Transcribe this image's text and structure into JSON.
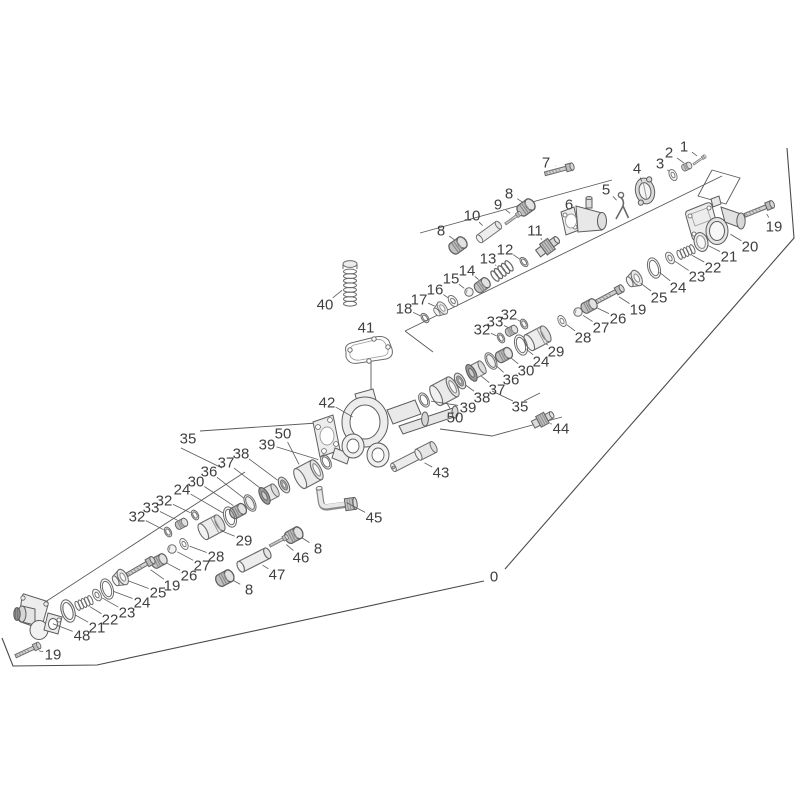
{
  "meta": {
    "background": "#ffffff",
    "label_color": "#3f3f3f",
    "label_font_size": 15,
    "leader_color": "#5a5a5a",
    "construction_color": "#5a5a5a",
    "boundary_color": "#4a4a4a",
    "part_stroke": "#6a6a6a"
  },
  "boundary": {
    "label": "0",
    "label_pos": [
      494,
      576
    ],
    "segments": [
      [
        [
          787,
          148
        ],
        [
          794,
          238
        ],
        [
          505,
          569
        ]
      ],
      [
        [
          484,
          581
        ],
        [
          97,
          665
        ],
        [
          13,
          666
        ],
        [
          2,
          638
        ]
      ]
    ]
  },
  "construction_lines": [
    [
      [
        612,
        180
      ],
      [
        420,
        233
      ]
    ],
    [
      [
        722,
        176
      ],
      [
        405,
        331
      ]
    ],
    [
      [
        405,
        331
      ],
      [
        433,
        352
      ]
    ],
    [
      [
        712,
        170
      ],
      [
        740,
        178
      ],
      [
        726,
        204
      ],
      [
        698,
        196
      ],
      [
        712,
        170
      ]
    ],
    [
      [
        245,
        472
      ],
      [
        36,
        608
      ]
    ],
    [
      [
        200,
        431
      ],
      [
        317,
        423
      ]
    ],
    [
      [
        181,
        448
      ],
      [
        222,
        468
      ]
    ],
    [
      [
        513,
        401
      ],
      [
        492,
        391
      ]
    ],
    [
      [
        524,
        401
      ],
      [
        540,
        393
      ]
    ],
    [
      [
        371,
        362
      ],
      [
        371,
        392
      ]
    ],
    [
      [
        440,
        429
      ],
      [
        492,
        436
      ],
      [
        562,
        417
      ]
    ]
  ],
  "parts": [
    {
      "label": "42",
      "type": "pumpbody",
      "x": 375,
      "y": 430,
      "lx": 327,
      "ly": 402,
      "rot": 0,
      "s": 1,
      "gap": 26
    },
    {
      "label": "20",
      "type": "manifold20",
      "x": 715,
      "y": 225,
      "lx": 750,
      "ly": 246,
      "rot": 0,
      "s": 1,
      "gap": 18
    },
    {
      "label": "48",
      "type": "manifold48",
      "x": 38,
      "y": 618,
      "lx": 82,
      "ly": 635,
      "rot": 0,
      "s": 1,
      "gap": 16
    },
    {
      "label": "6",
      "type": "valvebody",
      "x": 584,
      "y": 220,
      "lx": 569,
      "ly": 204,
      "rot": 0,
      "s": 1,
      "gap": 12
    },
    {
      "label": "7",
      "type": "bolt",
      "x": 563,
      "y": 169,
      "lx": 546,
      "ly": 162,
      "rot": -15,
      "s": 1.1,
      "gap": 8
    },
    {
      "label": "1",
      "type": "bolt",
      "x": 701,
      "y": 159,
      "lx": 684,
      "ly": 146,
      "rot": -35,
      "s": 0.55,
      "gap": 5
    },
    {
      "label": "2",
      "type": "nut",
      "x": 688,
      "y": 166,
      "lx": 669,
      "ly": 152,
      "rot": -25,
      "s": 0.7,
      "gap": 5
    },
    {
      "label": "3",
      "type": "washer",
      "x": 673,
      "y": 175,
      "lx": 660,
      "ly": 163,
      "rot": -25,
      "s": 0.85,
      "gap": 5
    },
    {
      "label": "4",
      "type": "flangedisc",
      "x": 645,
      "y": 191,
      "lx": 637,
      "ly": 168,
      "rot": -12,
      "s": 1,
      "gap": 10
    },
    {
      "label": "5",
      "type": "clip",
      "x": 622,
      "y": 206,
      "lx": 606,
      "ly": 189,
      "rot": 0,
      "s": 1,
      "gap": 8
    },
    {
      "label": "19",
      "type": "bolt",
      "x": 763,
      "y": 208,
      "lx": 774,
      "ly": 226,
      "rot": -22,
      "s": 1.15,
      "gap": 7
    },
    {
      "label": "21",
      "type": "plug",
      "x": 701,
      "y": 242,
      "lx": 729,
      "ly": 256,
      "rot": -15,
      "s": 1,
      "gap": 8
    },
    {
      "label": "22",
      "type": "spring",
      "x": 686,
      "y": 252,
      "lx": 713,
      "ly": 267,
      "rot": -24,
      "s": 1,
      "gap": 7
    },
    {
      "label": "23",
      "type": "washer",
      "x": 670,
      "y": 258,
      "lx": 697,
      "ly": 276,
      "rot": -28,
      "s": 0.9,
      "gap": 6
    },
    {
      "label": "24",
      "type": "bigring",
      "x": 654,
      "y": 268,
      "lx": 678,
      "ly": 287,
      "rot": -18,
      "s": 1,
      "gap": 7
    },
    {
      "label": "25",
      "type": "cup",
      "x": 635,
      "y": 279,
      "lx": 659,
      "ly": 297,
      "rot": -28,
      "s": 1,
      "gap": 7
    },
    {
      "label": "19",
      "type": "bolt",
      "x": 613,
      "y": 293,
      "lx": 638,
      "ly": 309,
      "rot": -28,
      "s": 1.15,
      "gap": 7
    },
    {
      "label": "26",
      "type": "nut",
      "x": 591,
      "y": 305,
      "lx": 618,
      "ly": 318,
      "rot": -28,
      "s": 1.1,
      "gap": 7
    },
    {
      "label": "27",
      "type": "ball",
      "x": 578,
      "y": 312,
      "lx": 601,
      "ly": 327,
      "rot": 0,
      "s": 1,
      "gap": 6
    },
    {
      "label": "28",
      "type": "washer",
      "x": 562,
      "y": 321,
      "lx": 583,
      "ly": 337,
      "rot": -28,
      "s": 0.85,
      "gap": 6
    },
    {
      "label": "32",
      "type": "orings",
      "x": 524,
      "y": 324,
      "lx": 509,
      "ly": 314,
      "rot": -28,
      "s": 1,
      "gap": 5
    },
    {
      "label": "33",
      "type": "nut",
      "x": 513,
      "y": 330,
      "lx": 495,
      "ly": 321,
      "rot": -28,
      "s": 0.85,
      "gap": 5
    },
    {
      "label": "32",
      "type": "orings",
      "x": 501,
      "y": 338,
      "lx": 482,
      "ly": 329,
      "rot": -28,
      "s": 1,
      "gap": 5
    },
    {
      "label": "29",
      "type": "piston",
      "x": 538,
      "y": 338,
      "lx": 556,
      "ly": 351,
      "rot": -28,
      "s": 1.1,
      "gap": 10
    },
    {
      "label": "24",
      "type": "bigring",
      "x": 521,
      "y": 345,
      "lx": 541,
      "ly": 361,
      "rot": -18,
      "s": 1,
      "gap": 7
    },
    {
      "label": "30",
      "type": "nut",
      "x": 506,
      "y": 354,
      "lx": 526,
      "ly": 370,
      "rot": -28,
      "s": 1.15,
      "gap": 7
    },
    {
      "label": "36",
      "type": "sealring",
      "x": 491,
      "y": 361,
      "lx": 511,
      "ly": 379,
      "rot": -28,
      "s": 1,
      "gap": 7
    },
    {
      "label": "37",
      "type": "pack",
      "x": 475,
      "y": 371,
      "lx": 497,
      "ly": 389,
      "rot": -28,
      "s": 1,
      "gap": 8
    },
    {
      "label": "38",
      "type": "seal",
      "x": 460,
      "y": 381,
      "lx": 482,
      "ly": 397,
      "rot": -28,
      "s": 1,
      "gap": 7
    },
    {
      "label": "39",
      "type": "oring",
      "x": 424,
      "y": 400,
      "lx": 468,
      "ly": 407,
      "rot": -28,
      "s": 1,
      "gap": 7
    },
    {
      "label": "50",
      "type": "sleeve",
      "x": 441,
      "y": 393,
      "lx": 455,
      "ly": 417,
      "rot": -28,
      "s": 1.1,
      "gap": 11
    },
    {
      "label": "35",
      "type": "none",
      "lx": 520,
      "ly": 406
    },
    {
      "label": "44",
      "type": "cart",
      "x": 542,
      "y": 420,
      "lx": 561,
      "ly": 428,
      "rot": -28,
      "s": 1,
      "gap": 9
    },
    {
      "label": "8",
      "type": "nut",
      "x": 528,
      "y": 206,
      "lx": 509,
      "ly": 193,
      "rot": -36,
      "s": 1.25,
      "gap": 7
    },
    {
      "label": "9",
      "type": "bolt",
      "x": 515,
      "y": 217,
      "lx": 498,
      "ly": 204,
      "rot": -36,
      "s": 0.7,
      "gap": 6
    },
    {
      "label": "10",
      "type": "rod",
      "x": 489,
      "y": 232,
      "lx": 472,
      "ly": 215,
      "rot": -36,
      "s": 0.9,
      "gap": 9
    },
    {
      "label": "8",
      "type": "nut",
      "x": 460,
      "y": 244,
      "lx": 441,
      "ly": 230,
      "rot": -36,
      "s": 1.25,
      "gap": 7
    },
    {
      "label": "11",
      "type": "cart",
      "x": 547,
      "y": 247,
      "lx": 535,
      "ly": 230,
      "rot": -36,
      "s": 1.1,
      "gap": 9
    },
    {
      "label": "12",
      "type": "orings",
      "x": 524,
      "y": 262,
      "lx": 505,
      "ly": 249,
      "rot": -36,
      "s": 1,
      "gap": 5
    },
    {
      "label": "13",
      "type": "spring",
      "x": 502,
      "y": 271,
      "lx": 488,
      "ly": 258,
      "rot": -36,
      "s": 1.25,
      "gap": 8
    },
    {
      "label": "14",
      "type": "nut",
      "x": 484,
      "y": 284,
      "lx": 467,
      "ly": 270,
      "rot": -36,
      "s": 1.1,
      "gap": 7
    },
    {
      "label": "15",
      "type": "ball",
      "x": 469,
      "y": 292,
      "lx": 451,
      "ly": 278,
      "rot": 0,
      "s": 1,
      "gap": 6
    },
    {
      "label": "16",
      "type": "washer",
      "x": 453,
      "y": 301,
      "lx": 435,
      "ly": 289,
      "rot": -36,
      "s": 0.9,
      "gap": 6
    },
    {
      "label": "17",
      "type": "cup",
      "x": 441,
      "y": 309,
      "lx": 419,
      "ly": 299,
      "rot": -36,
      "s": 0.85,
      "gap": 7
    },
    {
      "label": "18",
      "type": "orings",
      "x": 425,
      "y": 318,
      "lx": 404,
      "ly": 308,
      "rot": -36,
      "s": 1,
      "gap": 5
    },
    {
      "label": "40",
      "type": "springv",
      "x": 350,
      "y": 284,
      "lx": 325,
      "ly": 304,
      "rot": 0,
      "s": 1,
      "gap": 10
    },
    {
      "label": "41",
      "type": "gasket",
      "x": 369,
      "y": 349,
      "lx": 366,
      "ly": 327,
      "rot": 0,
      "s": 1,
      "gap": 12
    },
    {
      "label": "43",
      "type": "rodstep",
      "x": 414,
      "y": 457,
      "lx": 441,
      "ly": 472,
      "rot": -27,
      "s": 1,
      "gap": 12
    },
    {
      "label": "45",
      "type": "elbow",
      "x": 336,
      "y": 497,
      "lx": 374,
      "ly": 517,
      "rot": -8,
      "s": 1,
      "gap": 12
    },
    {
      "label": "8",
      "type": "nut",
      "x": 296,
      "y": 534,
      "lx": 318,
      "ly": 548,
      "rot": -28,
      "s": 1.25,
      "gap": 7
    },
    {
      "label": "46",
      "type": "bolt",
      "x": 281,
      "y": 540,
      "lx": 301,
      "ly": 557,
      "rot": -28,
      "s": 0.75,
      "gap": 7
    },
    {
      "label": "47",
      "type": "rod",
      "x": 254,
      "y": 560,
      "lx": 277,
      "ly": 574,
      "rot": -27,
      "s": 1.15,
      "gap": 10
    },
    {
      "label": "8",
      "type": "nut",
      "x": 227,
      "y": 577,
      "lx": 249,
      "ly": 589,
      "rot": -28,
      "s": 1.25,
      "gap": 7
    },
    {
      "label": "35",
      "type": "none",
      "lx": 188,
      "ly": 438
    },
    {
      "label": "50",
      "type": "sleeve",
      "x": 305,
      "y": 476,
      "lx": 283,
      "ly": 433,
      "rot": -28,
      "s": 1.1,
      "gap": 13
    },
    {
      "label": "39",
      "type": "oring",
      "x": 326,
      "y": 462,
      "lx": 267,
      "ly": 444,
      "rot": -28,
      "s": 1,
      "gap": 8
    },
    {
      "label": "38",
      "type": "seal",
      "x": 284,
      "y": 485,
      "lx": 241,
      "ly": 453,
      "rot": -28,
      "s": 1,
      "gap": 8
    },
    {
      "label": "37",
      "type": "pack",
      "x": 268,
      "y": 494,
      "lx": 226,
      "ly": 462,
      "rot": -28,
      "s": 1,
      "gap": 9
    },
    {
      "label": "36",
      "type": "sealring",
      "x": 250,
      "y": 503,
      "lx": 209,
      "ly": 471,
      "rot": -28,
      "s": 1,
      "gap": 8
    },
    {
      "label": "30",
      "type": "nut",
      "x": 240,
      "y": 510,
      "lx": 196,
      "ly": 481,
      "rot": -28,
      "s": 1.15,
      "gap": 8
    },
    {
      "label": "24",
      "type": "bigring",
      "x": 230,
      "y": 517,
      "lx": 182,
      "ly": 489,
      "rot": -18,
      "s": 1,
      "gap": 8
    },
    {
      "label": "32",
      "type": "orings",
      "x": 195,
      "y": 515,
      "lx": 164,
      "ly": 500,
      "rot": -28,
      "s": 1,
      "gap": 5
    },
    {
      "label": "33",
      "type": "nut",
      "x": 183,
      "y": 523,
      "lx": 151,
      "ly": 507,
      "rot": -28,
      "s": 0.85,
      "gap": 6
    },
    {
      "label": "32",
      "type": "orings",
      "x": 168,
      "y": 532,
      "lx": 137,
      "ly": 516,
      "rot": -28,
      "s": 1,
      "gap": 5
    },
    {
      "label": "29",
      "type": "piston",
      "x": 212,
      "y": 527,
      "lx": 244,
      "ly": 540,
      "rot": -28,
      "s": 1.1,
      "gap": 10
    },
    {
      "label": "28",
      "type": "washer",
      "x": 184,
      "y": 544,
      "lx": 216,
      "ly": 556,
      "rot": -28,
      "s": 0.85,
      "gap": 6
    },
    {
      "label": "27",
      "type": "ball",
      "x": 172,
      "y": 549,
      "lx": 202,
      "ly": 565,
      "rot": 0,
      "s": 1,
      "gap": 6
    },
    {
      "label": "26",
      "type": "nut",
      "x": 161,
      "y": 560,
      "lx": 189,
      "ly": 575,
      "rot": -28,
      "s": 1.1,
      "gap": 7
    },
    {
      "label": "19",
      "type": "bolt",
      "x": 144,
      "y": 565,
      "lx": 172,
      "ly": 585,
      "rot": -30,
      "s": 1.15,
      "gap": 8
    },
    {
      "label": "25",
      "type": "cup",
      "x": 121,
      "y": 578,
      "lx": 158,
      "ly": 592,
      "rot": -28,
      "s": 1,
      "gap": 8
    },
    {
      "label": "24",
      "type": "bigring",
      "x": 107,
      "y": 589,
      "lx": 142,
      "ly": 602,
      "rot": -18,
      "s": 1,
      "gap": 7
    },
    {
      "label": "23",
      "type": "washer",
      "x": 97,
      "y": 595,
      "lx": 127,
      "ly": 612,
      "rot": -28,
      "s": 0.9,
      "gap": 6
    },
    {
      "label": "22",
      "type": "spring",
      "x": 84,
      "y": 603,
      "lx": 110,
      "ly": 619,
      "rot": -24,
      "s": 1,
      "gap": 7
    },
    {
      "label": "21",
      "type": "bigring",
      "x": 68,
      "y": 611,
      "lx": 97,
      "ly": 627,
      "rot": -18,
      "s": 1.1,
      "gap": 8
    },
    {
      "label": "19",
      "type": "bolt",
      "x": 31,
      "y": 649,
      "lx": 53,
      "ly": 654,
      "rot": -25,
      "s": 1,
      "gap": 8
    }
  ]
}
